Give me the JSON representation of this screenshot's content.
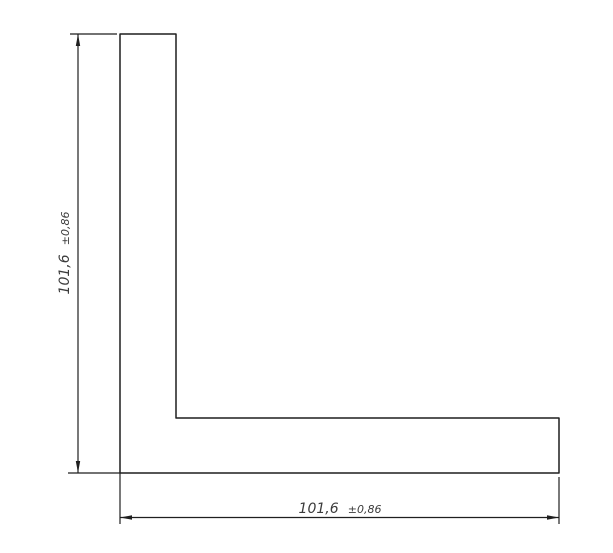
{
  "drawing": {
    "colors": {
      "background": "#ffffff",
      "line": "#1f1f1f",
      "dimension_text": "#3c3c3c"
    },
    "dimensions": {
      "vertical": {
        "value": "101,6",
        "tolerance": "±0,86",
        "label": "101,6 ±0,86"
      },
      "horizontal": {
        "value": "101,6",
        "tolerance": "±0,86",
        "label": "101,6 ±0,86"
      }
    }
  }
}
